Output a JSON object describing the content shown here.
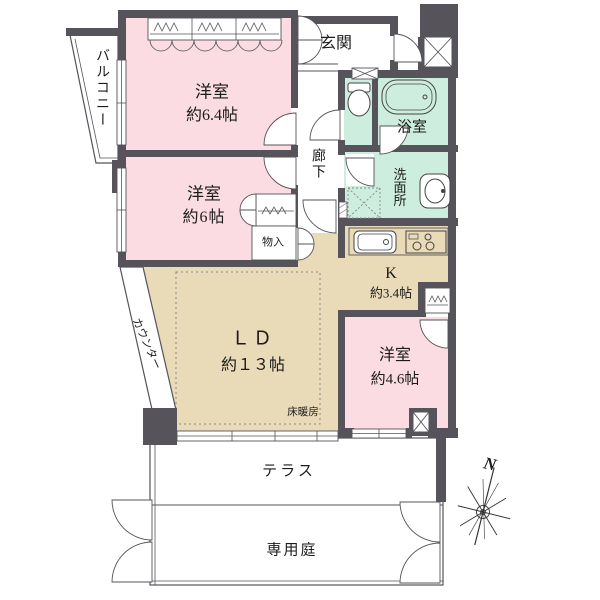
{
  "colors": {
    "room_pink": "#fadce2",
    "water_mint": "#cdeede",
    "wood_beige": "#e9dab8",
    "wall_gray": "#56545a"
  },
  "rooms": {
    "bedroom_64": {
      "name": "洋室",
      "size": "約6.4帖"
    },
    "bedroom_6": {
      "name": "洋室",
      "size": "約6帖"
    },
    "bedroom_46": {
      "name": "洋室",
      "size": "約4.6帖"
    },
    "living_dining": {
      "name": "ＬＤ",
      "size": "約１３帖"
    },
    "kitchen": {
      "name": "K",
      "size": "約3.4帖"
    },
    "entrance": {
      "name": "玄関"
    },
    "corridor": {
      "name": "廊下"
    },
    "bathroom": {
      "name": "浴室"
    },
    "washroom": {
      "name": "洗面所"
    },
    "storage": {
      "name": "物入"
    },
    "balcony": {
      "name": "バルコニー"
    },
    "terrace": {
      "name": "テラス"
    },
    "private_garden": {
      "name": "専用庭"
    }
  },
  "annotations": {
    "floor_heating": "床暖房",
    "counter": "カウンター",
    "compass_north": "N"
  }
}
